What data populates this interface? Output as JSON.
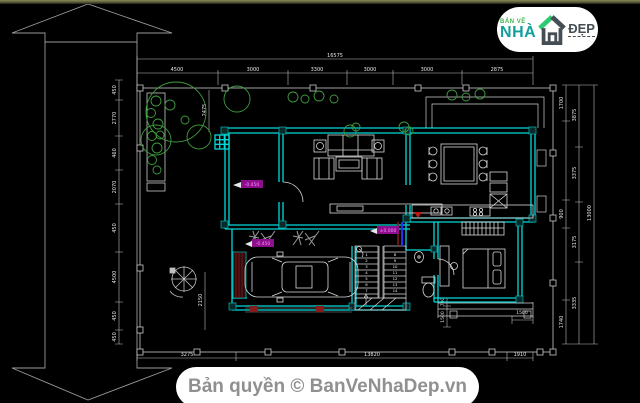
{
  "meta": {
    "background": "#000000",
    "top_border_color": "#73734a"
  },
  "logo": {
    "tagline": "BẢN VẼ",
    "brand_main": "NHÀ",
    "brand_accent": "ĐẸP",
    "tagline_color": "#3db54a",
    "main_color": "#149e9b",
    "accent_color": "#454e54"
  },
  "footer": {
    "text": "Bản quyền © BanVeNhaDep.vn"
  },
  "plan": {
    "colors": {
      "wall": "#00d9d9",
      "line": "#cfcfcf",
      "plant": "#3f9b3f",
      "dim_text": "#e6e6e6",
      "elevation_bg": "#8e0f8e",
      "elevation_text": "#ff8cff",
      "accent_red": "#8b1a1a",
      "accent_blue": "#2a2aff"
    },
    "dims": {
      "top_total": "16575",
      "top": [
        "4500",
        "3000",
        "3300",
        "3000",
        "3000",
        "2875"
      ],
      "left": [
        "450",
        "2770",
        "460",
        "2070",
        "450",
        "4500",
        "450",
        "450"
      ],
      "right_col1": [
        "1700",
        "900",
        "1740"
      ],
      "right_col2": [
        "3875",
        "3375",
        "3175",
        "3335"
      ],
      "right_total": "13000",
      "bottom": [
        "3275",
        "13820",
        "1910"
      ],
      "porch_width": "2475",
      "yard_height": "2150",
      "wc": [
        "700",
        "1500"
      ],
      "back_step": "1500"
    },
    "elevations": [
      "-0.450",
      "-0.450",
      "±0.000"
    ],
    "stairs_numbers": [
      "1",
      "2",
      "3",
      "4",
      "5",
      "6",
      "7",
      "8",
      "9",
      "10",
      "11",
      "12",
      "13",
      "14"
    ]
  }
}
